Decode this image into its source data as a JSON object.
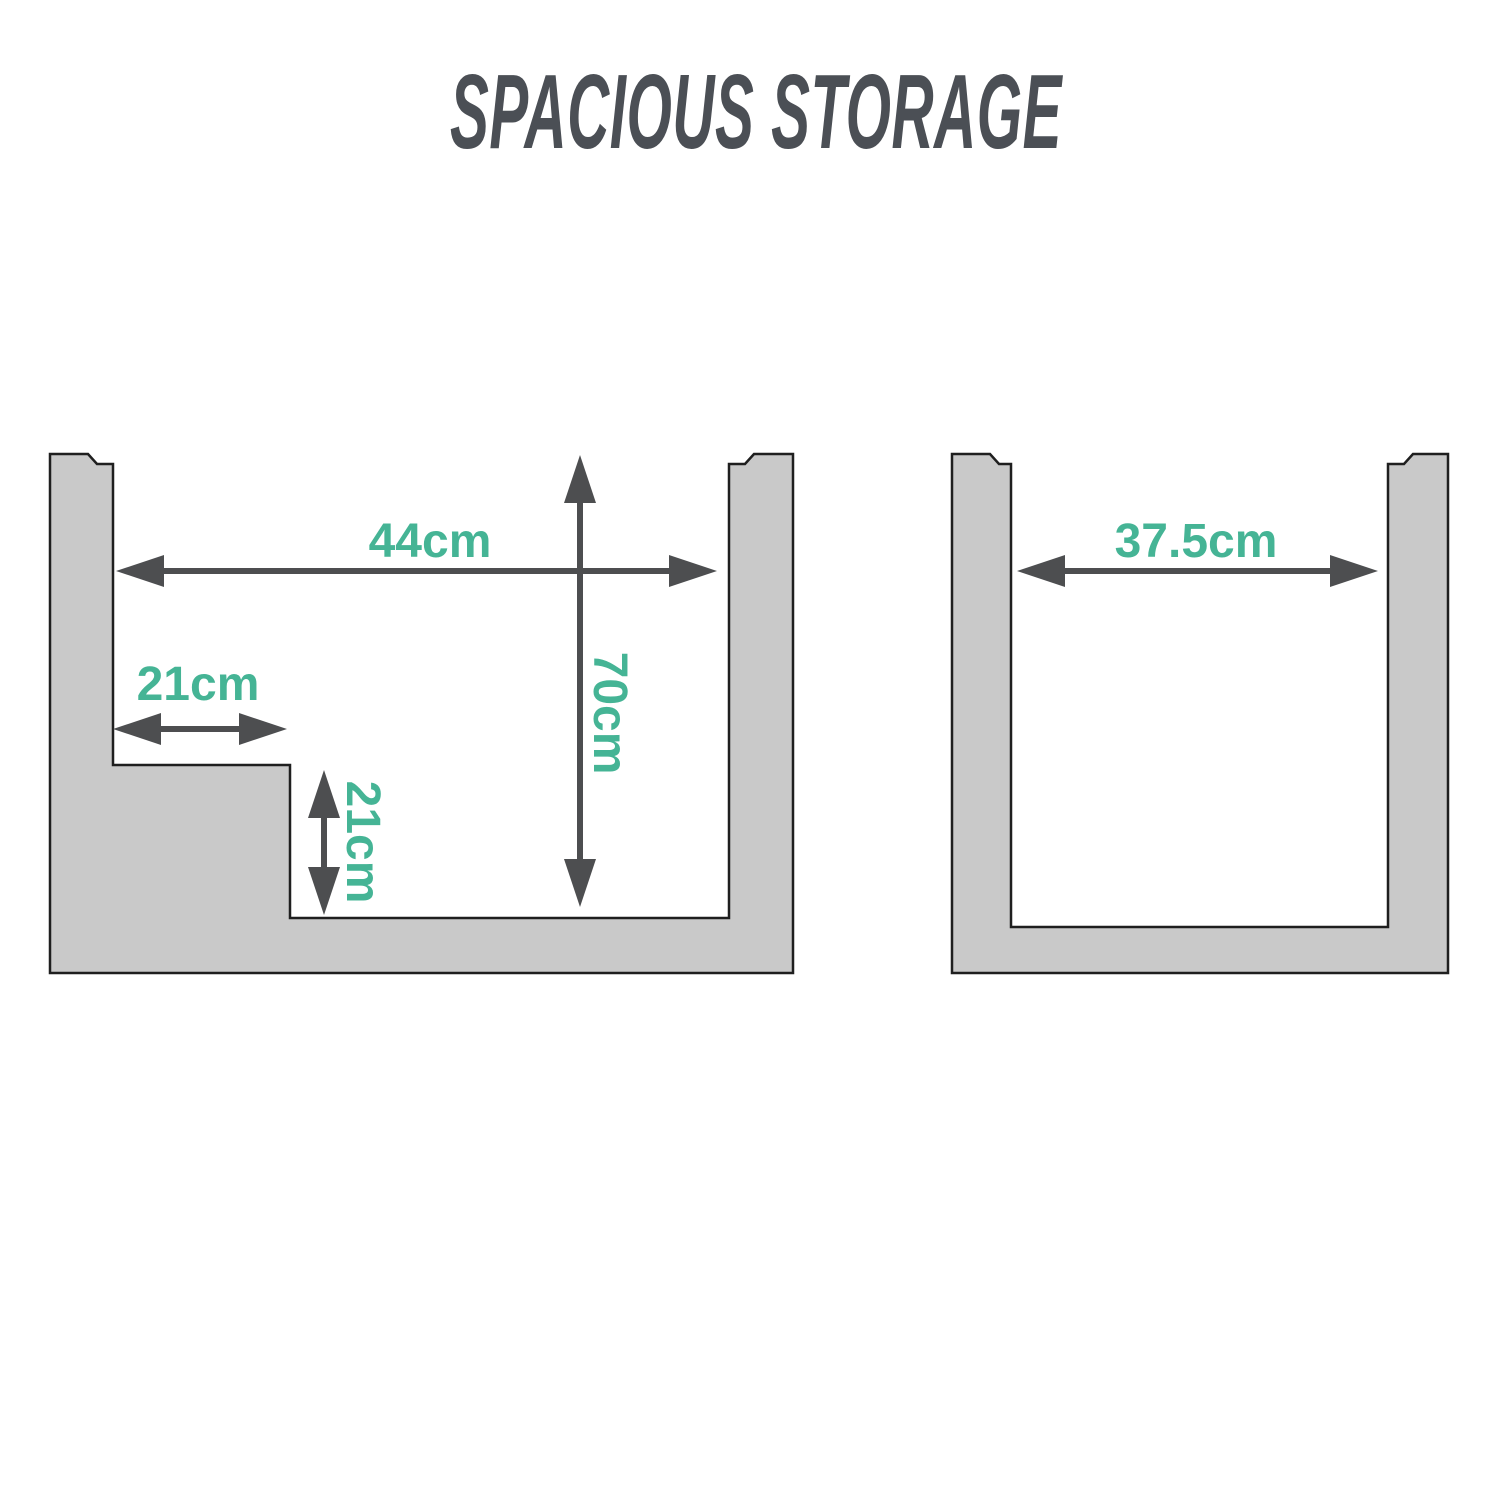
{
  "title": "SPACIOUS STORAGE",
  "left_unit": {
    "name": "stepped storage cross-section",
    "interior_width": "44cm",
    "interior_depth": "70cm",
    "step_width": "21cm",
    "step_height": "21cm"
  },
  "right_unit": {
    "name": "plain storage cross-section",
    "interior_width": "37.5cm"
  },
  "colors": {
    "wall_fill": "#c9c9c9",
    "outline": "#1f1f1f",
    "arrow": "#4d4e50",
    "dimension_text": "#45b495",
    "title_text": "#4b4f55"
  }
}
